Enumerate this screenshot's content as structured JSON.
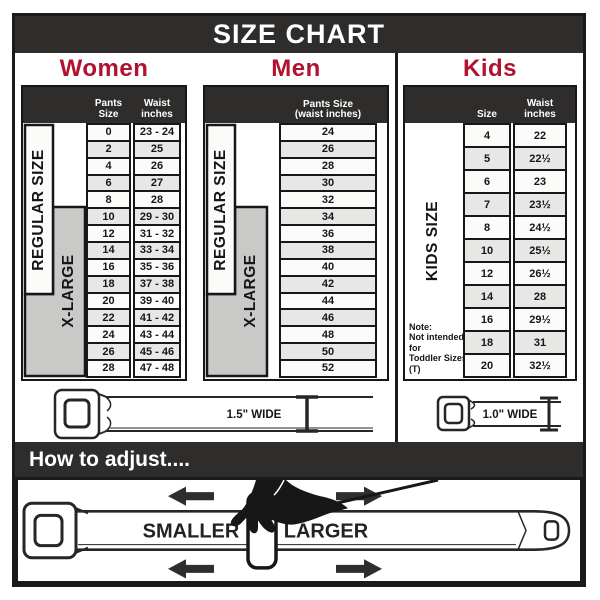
{
  "title": "SIZE CHART",
  "sections": {
    "women": {
      "title": "Women",
      "col_headers": {
        "size": "Pants Size",
        "waist": "Waist inches"
      },
      "side_labels": {
        "regular": "REGULAR SIZE",
        "xlarge": "X-LARGE"
      },
      "rows": [
        {
          "size": "0",
          "waist": "23 - 24"
        },
        {
          "size": "2",
          "waist": "25"
        },
        {
          "size": "4",
          "waist": "26"
        },
        {
          "size": "6",
          "waist": "27"
        },
        {
          "size": "8",
          "waist": "28"
        },
        {
          "size": "10",
          "waist": "29 - 30"
        },
        {
          "size": "12",
          "waist": "31 - 32"
        },
        {
          "size": "14",
          "waist": "33 - 34"
        },
        {
          "size": "16",
          "waist": "35 - 36"
        },
        {
          "size": "18",
          "waist": "37 - 38"
        },
        {
          "size": "20",
          "waist": "39 - 40"
        },
        {
          "size": "22",
          "waist": "41 - 42"
        },
        {
          "size": "24",
          "waist": "43 - 44"
        },
        {
          "size": "26",
          "waist": "45 - 46"
        },
        {
          "size": "28",
          "waist": "47 - 48"
        }
      ]
    },
    "men": {
      "title": "Men",
      "col_header_line1": "Pants Size",
      "col_header_line2": "(waist inches)",
      "side_labels": {
        "regular": "REGULAR SIZE",
        "xlarge": "X-LARGE"
      },
      "rows": [
        "24",
        "26",
        "28",
        "30",
        "32",
        "34",
        "36",
        "38",
        "40",
        "42",
        "44",
        "46",
        "48",
        "50",
        "52"
      ]
    },
    "kids": {
      "title": "Kids",
      "col_headers": {
        "size": "Size",
        "waist": "Waist inches"
      },
      "side_label": "KIDS SIZE",
      "note": [
        "Note:",
        "Not intended for",
        "Toddler Sizes (T)"
      ],
      "rows": [
        {
          "size": "4",
          "waist": "22"
        },
        {
          "size": "5",
          "waist": "22½"
        },
        {
          "size": "6",
          "waist": "23"
        },
        {
          "size": "7",
          "waist": "23½"
        },
        {
          "size": "8",
          "waist": "24½"
        },
        {
          "size": "10",
          "waist": "25½"
        },
        {
          "size": "12",
          "waist": "26½"
        },
        {
          "size": "14",
          "waist": "28"
        },
        {
          "size": "16",
          "waist": "29½"
        },
        {
          "size": "18",
          "waist": "31"
        },
        {
          "size": "20",
          "waist": "32½"
        }
      ]
    }
  },
  "belts": {
    "adult_width_label": "1.5\" WIDE",
    "kids_width_label": "1.0\" WIDE"
  },
  "how_to": {
    "title": "How to adjust....",
    "smaller": "SMALLER",
    "larger": "LARGER"
  },
  "colors": {
    "banner_dark": "#2e2d2b",
    "accent_red": "#b0122f",
    "label_gray": "#c9c9c8",
    "row_alt": "#e7e7e6",
    "border_black": "#171717"
  }
}
